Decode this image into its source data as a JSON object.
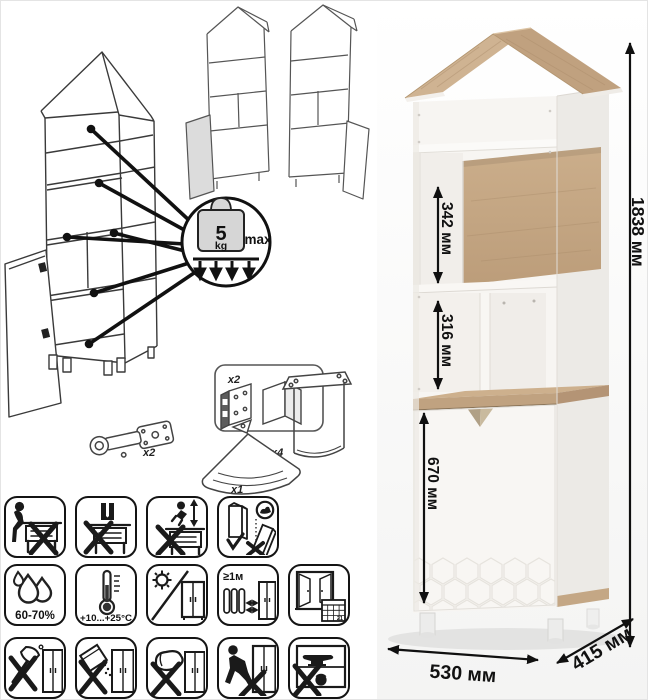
{
  "left_panel": {
    "weight_limit": {
      "value": "5",
      "unit": "kg",
      "suffix": "max"
    },
    "hardware": {
      "hinge_qty": "x2",
      "bracket_qty": "x2",
      "handle_qty": "x1",
      "leg_qty": "x4"
    }
  },
  "care_panel": {
    "humidity": "60-70%",
    "temperature": "+10...+25°C",
    "heater_distance": "≥1м",
    "calendar_day": "21",
    "row1_icons": [
      "no-sitting",
      "no-standing",
      "no-jumping",
      "carry-upright-only"
    ],
    "row2_icons": [
      "humidity-range",
      "temperature-range",
      "no-direct-sunlight",
      "keep-1m-from-heaters",
      "ventilate-room"
    ],
    "row3_icons": [
      "no-sharp-tools",
      "no-abrasive-powders",
      "no-scouring-pads",
      "no-dragging",
      "no-heavy-loads"
    ]
  },
  "product": {
    "dimensions": {
      "height": "1838 мм",
      "upper_compartment": "342 мм",
      "middle_compartment": "316 мм",
      "door_section": "670 мм",
      "width": "530 мм",
      "depth": "415 мм"
    },
    "colors": {
      "oak": "#c4a784",
      "white_panel": "#f7f5f2",
      "dimension_text": "#111111"
    }
  }
}
